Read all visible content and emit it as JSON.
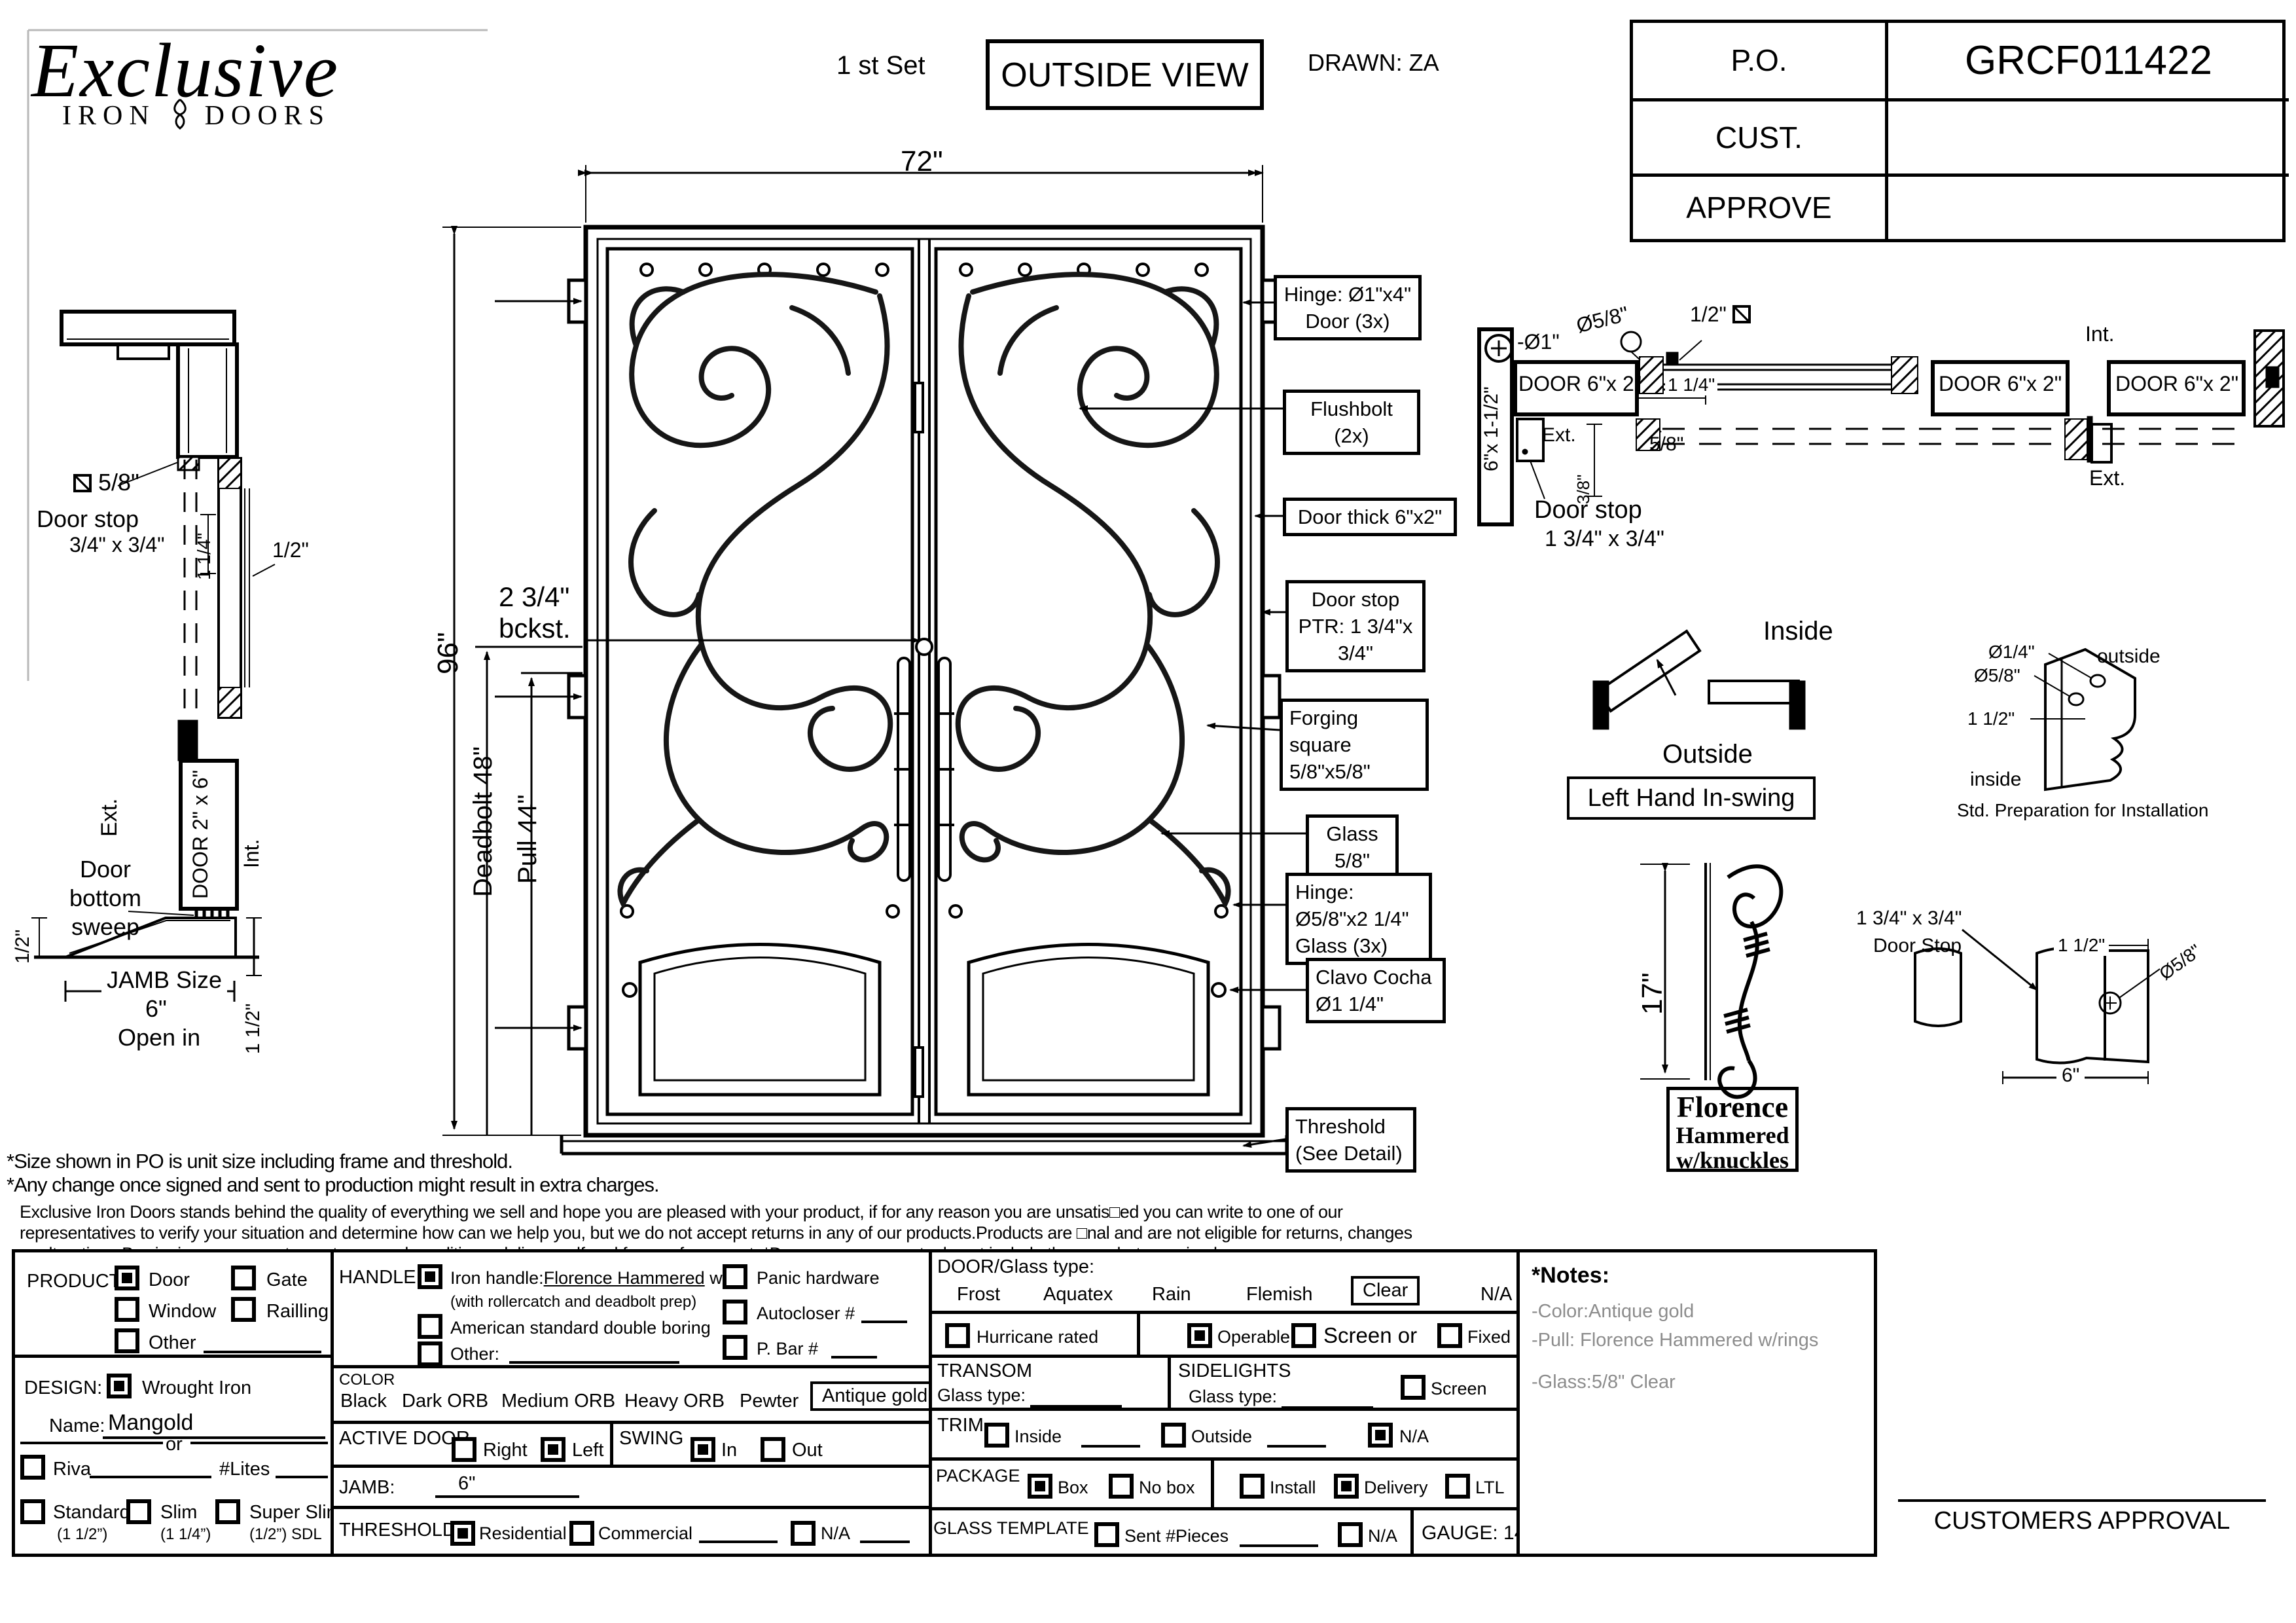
{
  "header": {
    "logo": {
      "name": "Exclusive",
      "sub_left": "IRON",
      "sub_right": "DOORS"
    },
    "set_label": "1 st Set",
    "view_label": "OUTSIDE VIEW",
    "drawn": "DRAWN: ZA",
    "title_block": {
      "po_label": "P.O.",
      "po_value": "GRCF011422",
      "cust_label": "CUST.",
      "cust_value": "",
      "approve_label": "APPROVE",
      "approve_value": ""
    }
  },
  "elevation": {
    "width_dim": "72\"",
    "height_dim": "96\"",
    "backset1": "2 3/4\"",
    "backset2": "bckst.",
    "deadbolt": "Deadbolt 48\"",
    "pull": "Pull 44\"",
    "callouts": [
      {
        "l1": "Hinge: Ø1\"x4\"",
        "l2": "Door (3x)"
      },
      {
        "l1": "Flushbolt (2x)",
        "l2": ""
      },
      {
        "l1": "Door thick 6\"x2\"",
        "l2": ""
      },
      {
        "l1": "Door stop",
        "l2": "PTR: 1 3/4\"x 3/4\""
      },
      {
        "l1": "Forging square",
        "l2": "5/8\"x5/8\""
      },
      {
        "l1": "Glass 5/8\"",
        "l2": ""
      },
      {
        "l1": "Hinge: Ø5/8\"x2 1/4\"",
        "l2": "Glass (3x)"
      },
      {
        "l1": "Clavo Cocha",
        "l2": "Ø1 1/4\""
      },
      {
        "l1": "Threshold",
        "l2": "(See Detail)"
      }
    ]
  },
  "left_section": {
    "stop_size": "5/8\"",
    "door_stop": "Door stop",
    "stop_dim": "3/4\" x 3/4\"",
    "dim_114": "1 1/4\"",
    "dim_12": "1/2\"",
    "ext": "Ext.",
    "sweep1": "Door",
    "sweep2": "bottom",
    "sweep3": "sweep",
    "door_label": "DOOR 2\" x 6\"",
    "int": "Int.",
    "dim_12b": "1/2\"",
    "jamb1": "JAMB Size",
    "jamb2": "6\"",
    "jamb3": "Open in",
    "dim_112": "1 1/2\""
  },
  "head_section": {
    "dia1": "-Ø1\"",
    "dia58": "Ø5/8\"",
    "half": "1/2\"",
    "jamb_label": "6\"x 1-1/2\"",
    "door1": "DOOR 6\"x 2\"",
    "door2": "DOOR 6\"x 2\"",
    "door3": "DOOR 6\"x 2\"",
    "ext1": "Ext.",
    "dim114": "1 1/4\"",
    "dim58": "5/8\"",
    "dim38": "3/8\"",
    "doorstop1": "Door stop",
    "doorstop2": "1 3/4\" x 3/4\"",
    "int1": "Int.",
    "ext2": "Ext."
  },
  "swing": {
    "inside": "Inside",
    "outside": "Outside",
    "label": "Left Hand In-swing"
  },
  "prep": {
    "d14": "Ø1/4\"",
    "d58": "Ø5/8\"",
    "d112": "1 1/2\"",
    "outside": "outside",
    "inside": "inside",
    "caption": "Std. Preparation for Installation"
  },
  "handle_detail": {
    "dim": "17\"",
    "box1": "Florence",
    "box2": "Hammered",
    "box3": "w/knuckles"
  },
  "stop_detail": {
    "t1": "1 3/4\" x 3/4\"",
    "t2": "Door Stop",
    "d112": "1 1/2\"",
    "d58": "Ø5/8\"",
    "d6": "6\""
  },
  "disclaimer": {
    "line1": "*Size shown in PO is unit size including frame and threshold.",
    "line2": "*Any change once signed and sent to production might result in extra charges.",
    "para1": "Exclusive Iron Doors stands behind the quality of everything we sell and hope you are pleased with your product, if for any reason you are unsatis□ed you can write to one of our",
    "para2": "representatives to verify your situation and determine how can we help you, but we do not accept returns in any of our products.Products are □nal and are not eligible for returns, changes",
    "para3": "or alterations.By signing you agree to our terms and conditions, delivery pdf and forms of payment. *Doors measurements do not include the gaps between jambs"
  },
  "form": {
    "product": {
      "label": "PRODUCT:",
      "opt_door": "Door",
      "opt_gate": "Gate",
      "opt_window": "Window",
      "opt_railling": "Railling",
      "opt_other": "Other"
    },
    "design": {
      "label": "DESIGN:",
      "opt_wrought": "Wrought Iron",
      "name_label": "Name:",
      "name_value": "Mangold",
      "or": "or",
      "riva": "Riva",
      "lites": "#Lites",
      "standard": "Standard",
      "standard2": "(1 1/2”)",
      "slim": "Slim",
      "slim2": "(1 1/4”)",
      "superslim": "Super Slim",
      "superslim2": "(1/2”) SDL"
    },
    "handle": {
      "label": "HANDLE",
      "iron_pre": "Iron handle:",
      "iron_val": "Florence Hammered",
      "iron_suf": "w/r",
      "iron_sub": "(with rollercatch and deadbolt prep)",
      "american": "American standard double boring",
      "other": "Other:",
      "panic": "Panic hardware",
      "autocloser": "Autocloser #",
      "pbar": "P. Bar #"
    },
    "color": {
      "label": "COLOR",
      "opt1": "Black",
      "opt2": "Dark ORB",
      "opt3": "Medium ORB",
      "opt4": "Heavy ORB",
      "opt5": "Pewter",
      "opt6": "Antique gold"
    },
    "active": {
      "label": "ACTIVE DOOR",
      "right": "Right",
      "left": "Left"
    },
    "swing": {
      "label": "SWING",
      "in": "In",
      "out": "Out"
    },
    "jamb": {
      "label": "JAMB:",
      "value": "6\""
    },
    "threshold": {
      "label": "THRESHOLD",
      "residential": "Residential",
      "commercial": "Commercial",
      "na": "N/A"
    },
    "glass": {
      "label": "DOOR/Glass type:",
      "opt1": "Frost",
      "opt2": "Aquatex",
      "opt3": "Rain",
      "opt4": "Flemish",
      "opt5": "Clear",
      "opt6": "N/A",
      "hurricane": "Hurricane rated",
      "operable": "Operable",
      "screen_or": "Screen or",
      "fixed": "Fixed"
    },
    "transom": {
      "label": "TRANSOM",
      "glass_type": "Glass type:"
    },
    "sidelights": {
      "label": "SIDELIGHTS",
      "glass_type": "Glass type:",
      "screen": "Screen"
    },
    "trim": {
      "label": "TRIM",
      "inside": "Inside",
      "outside": "Outside",
      "na": "N/A"
    },
    "package": {
      "label": "PACKAGE",
      "box": "Box",
      "nobox": "No box",
      "install": "Install",
      "delivery": "Delivery",
      "ltl": "LTL"
    },
    "glass_template": {
      "label": "GLASS TEMPLATE",
      "sent": "Sent #Pieces",
      "na": "N/A",
      "gauge": "GAUGE: 14"
    },
    "notes": {
      "title": "*Notes:",
      "items": [
        "-Color:Antique gold",
        "-Pull: Florence Hammered w/rings",
        "-Glass:5/8\" Clear"
      ]
    },
    "approval": "CUSTOMERS APPROVAL"
  }
}
